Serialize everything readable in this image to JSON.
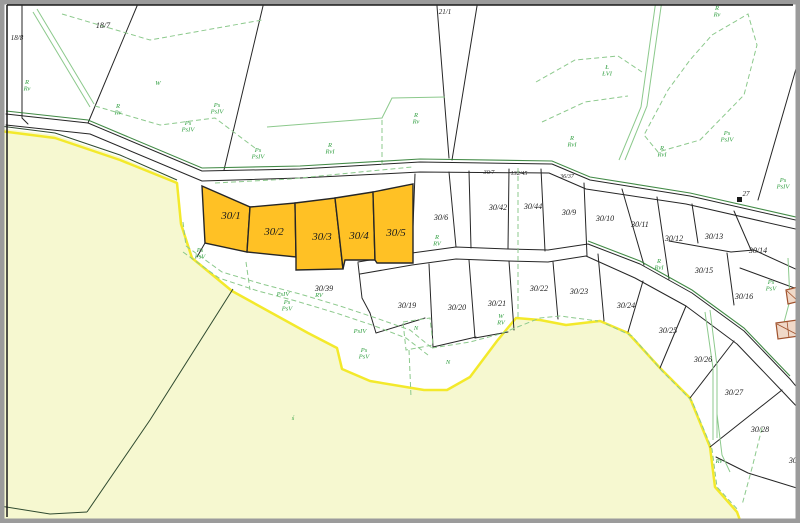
{
  "map": {
    "type": "cadastral-map",
    "highlighted_parcels": [
      "30/1",
      "30/2",
      "30/3",
      "30/4",
      "30/5"
    ],
    "colors": {
      "highlight_parcel_fill": "#ffc125",
      "parcel_outline": "#262626",
      "green_area_fill": "#f6f8d0",
      "green_area_border": "#f3e92b",
      "landuse_line": "#8cc98c",
      "landuse_label": "#2f9e3f",
      "road_edge_green": "#2e7d32",
      "building_outline": "#a0522d",
      "frame": "#9b9b9b"
    },
    "labels": {
      "parcels": [
        {
          "t": "18/8",
          "x": 17,
          "y": 40,
          "s": 7
        },
        {
          "t": "18/7",
          "x": 103,
          "y": 28,
          "s": 8
        },
        {
          "t": "21/1",
          "x": 445,
          "y": 14,
          "s": 7
        },
        {
          "t": "27",
          "x": 746,
          "y": 196,
          "s": 7
        },
        {
          "t": "30/1",
          "x": 231,
          "y": 219,
          "s": 11
        },
        {
          "t": "30/2",
          "x": 274,
          "y": 235,
          "s": 11
        },
        {
          "t": "30/3",
          "x": 322,
          "y": 240,
          "s": 11
        },
        {
          "t": "30/4",
          "x": 359,
          "y": 239,
          "s": 11
        },
        {
          "t": "30/5",
          "x": 396,
          "y": 236,
          "s": 11
        },
        {
          "t": "30/6",
          "x": 441,
          "y": 220,
          "s": 8
        },
        {
          "t": "30/7",
          "x": 489,
          "y": 174,
          "s": 6
        },
        {
          "t": "132/45",
          "x": 519,
          "y": 175,
          "s": 6
        },
        {
          "t": "36/37",
          "x": 567,
          "y": 178,
          "s": 6
        },
        {
          "t": "30/42",
          "x": 498,
          "y": 210,
          "s": 8
        },
        {
          "t": "30/44",
          "x": 533,
          "y": 209,
          "s": 8
        },
        {
          "t": "30/9",
          "x": 569,
          "y": 215,
          "s": 8
        },
        {
          "t": "30/10",
          "x": 605,
          "y": 221,
          "s": 8
        },
        {
          "t": "30/11",
          "x": 640,
          "y": 227,
          "s": 8
        },
        {
          "t": "30/12",
          "x": 674,
          "y": 241,
          "s": 8
        },
        {
          "t": "30/13",
          "x": 714,
          "y": 239,
          "s": 8
        },
        {
          "t": "30/14",
          "x": 758,
          "y": 253,
          "s": 8
        },
        {
          "t": "30/15",
          "x": 704,
          "y": 273,
          "s": 8
        },
        {
          "t": "30/16",
          "x": 744,
          "y": 299,
          "s": 8
        },
        {
          "t": "30/39",
          "x": 324,
          "y": 291,
          "s": 8
        },
        {
          "t": "30/19",
          "x": 407,
          "y": 308,
          "s": 8
        },
        {
          "t": "30/20",
          "x": 457,
          "y": 310,
          "s": 8
        },
        {
          "t": "30/21",
          "x": 497,
          "y": 306,
          "s": 8
        },
        {
          "t": "30/22",
          "x": 539,
          "y": 291,
          "s": 8
        },
        {
          "t": "30/23",
          "x": 579,
          "y": 294,
          "s": 8
        },
        {
          "t": "30/24",
          "x": 626,
          "y": 308,
          "s": 8
        },
        {
          "t": "30/25",
          "x": 668,
          "y": 333,
          "s": 8
        },
        {
          "t": "30/26",
          "x": 703,
          "y": 362,
          "s": 8
        },
        {
          "t": "30/27",
          "x": 734,
          "y": 395,
          "s": 8
        },
        {
          "t": "30/28",
          "x": 760,
          "y": 432,
          "s": 8
        },
        {
          "t": "30/",
          "x": 794,
          "y": 463,
          "s": 8
        }
      ],
      "landuse": [
        {
          "a": "R",
          "b": "Rv",
          "x": 27,
          "y": 84
        },
        {
          "a": "R",
          "b": "Rv",
          "x": 118,
          "y": 108
        },
        {
          "a": "W",
          "x": 158,
          "y": 85
        },
        {
          "a": "Ps",
          "b": "PsIV",
          "x": 188,
          "y": 125
        },
        {
          "a": "Ps",
          "b": "PsIV",
          "x": 217,
          "y": 107
        },
        {
          "a": "Ps",
          "b": "PsIV",
          "x": 258,
          "y": 152
        },
        {
          "a": "R",
          "b": "RvI",
          "x": 330,
          "y": 147
        },
        {
          "a": "R",
          "b": "Rv",
          "x": 416,
          "y": 117
        },
        {
          "a": "R",
          "b": "Rv",
          "x": 717,
          "y": 10
        },
        {
          "a": "Ł",
          "b": "ŁVI",
          "x": 607,
          "y": 69
        },
        {
          "a": "R",
          "b": "RvI",
          "x": 572,
          "y": 140
        },
        {
          "a": "R",
          "b": "RvI",
          "x": 662,
          "y": 150
        },
        {
          "a": "Ps",
          "b": "PsIV",
          "x": 727,
          "y": 135
        },
        {
          "a": "Ps",
          "b": "PsIV",
          "x": 783,
          "y": 182
        },
        {
          "a": "R",
          "b": "RV",
          "x": 437,
          "y": 239
        },
        {
          "a": "Ps",
          "b": "PsV",
          "x": 200,
          "y": 252
        },
        {
          "a": "PsIV",
          "x": 283,
          "y": 296
        },
        {
          "a": "Ps",
          "b": "PsV",
          "x": 287,
          "y": 304
        },
        {
          "a": "RV",
          "x": 319,
          "y": 297
        },
        {
          "a": "PsIV",
          "x": 360,
          "y": 333
        },
        {
          "a": "Ps",
          "b": "PsV",
          "x": 364,
          "y": 352
        },
        {
          "a": "N",
          "x": 416,
          "y": 330
        },
        {
          "a": "N",
          "x": 448,
          "y": 364
        },
        {
          "a": "W",
          "b": "RV",
          "x": 501,
          "y": 318
        },
        {
          "a": "R",
          "b": "RvI",
          "x": 659,
          "y": 263
        },
        {
          "a": "Ps",
          "b": "PsV",
          "x": 771,
          "y": 284
        },
        {
          "a": "ś",
          "x": 293,
          "y": 420
        },
        {
          "a": "Rv",
          "x": 719,
          "y": 463
        }
      ]
    }
  }
}
